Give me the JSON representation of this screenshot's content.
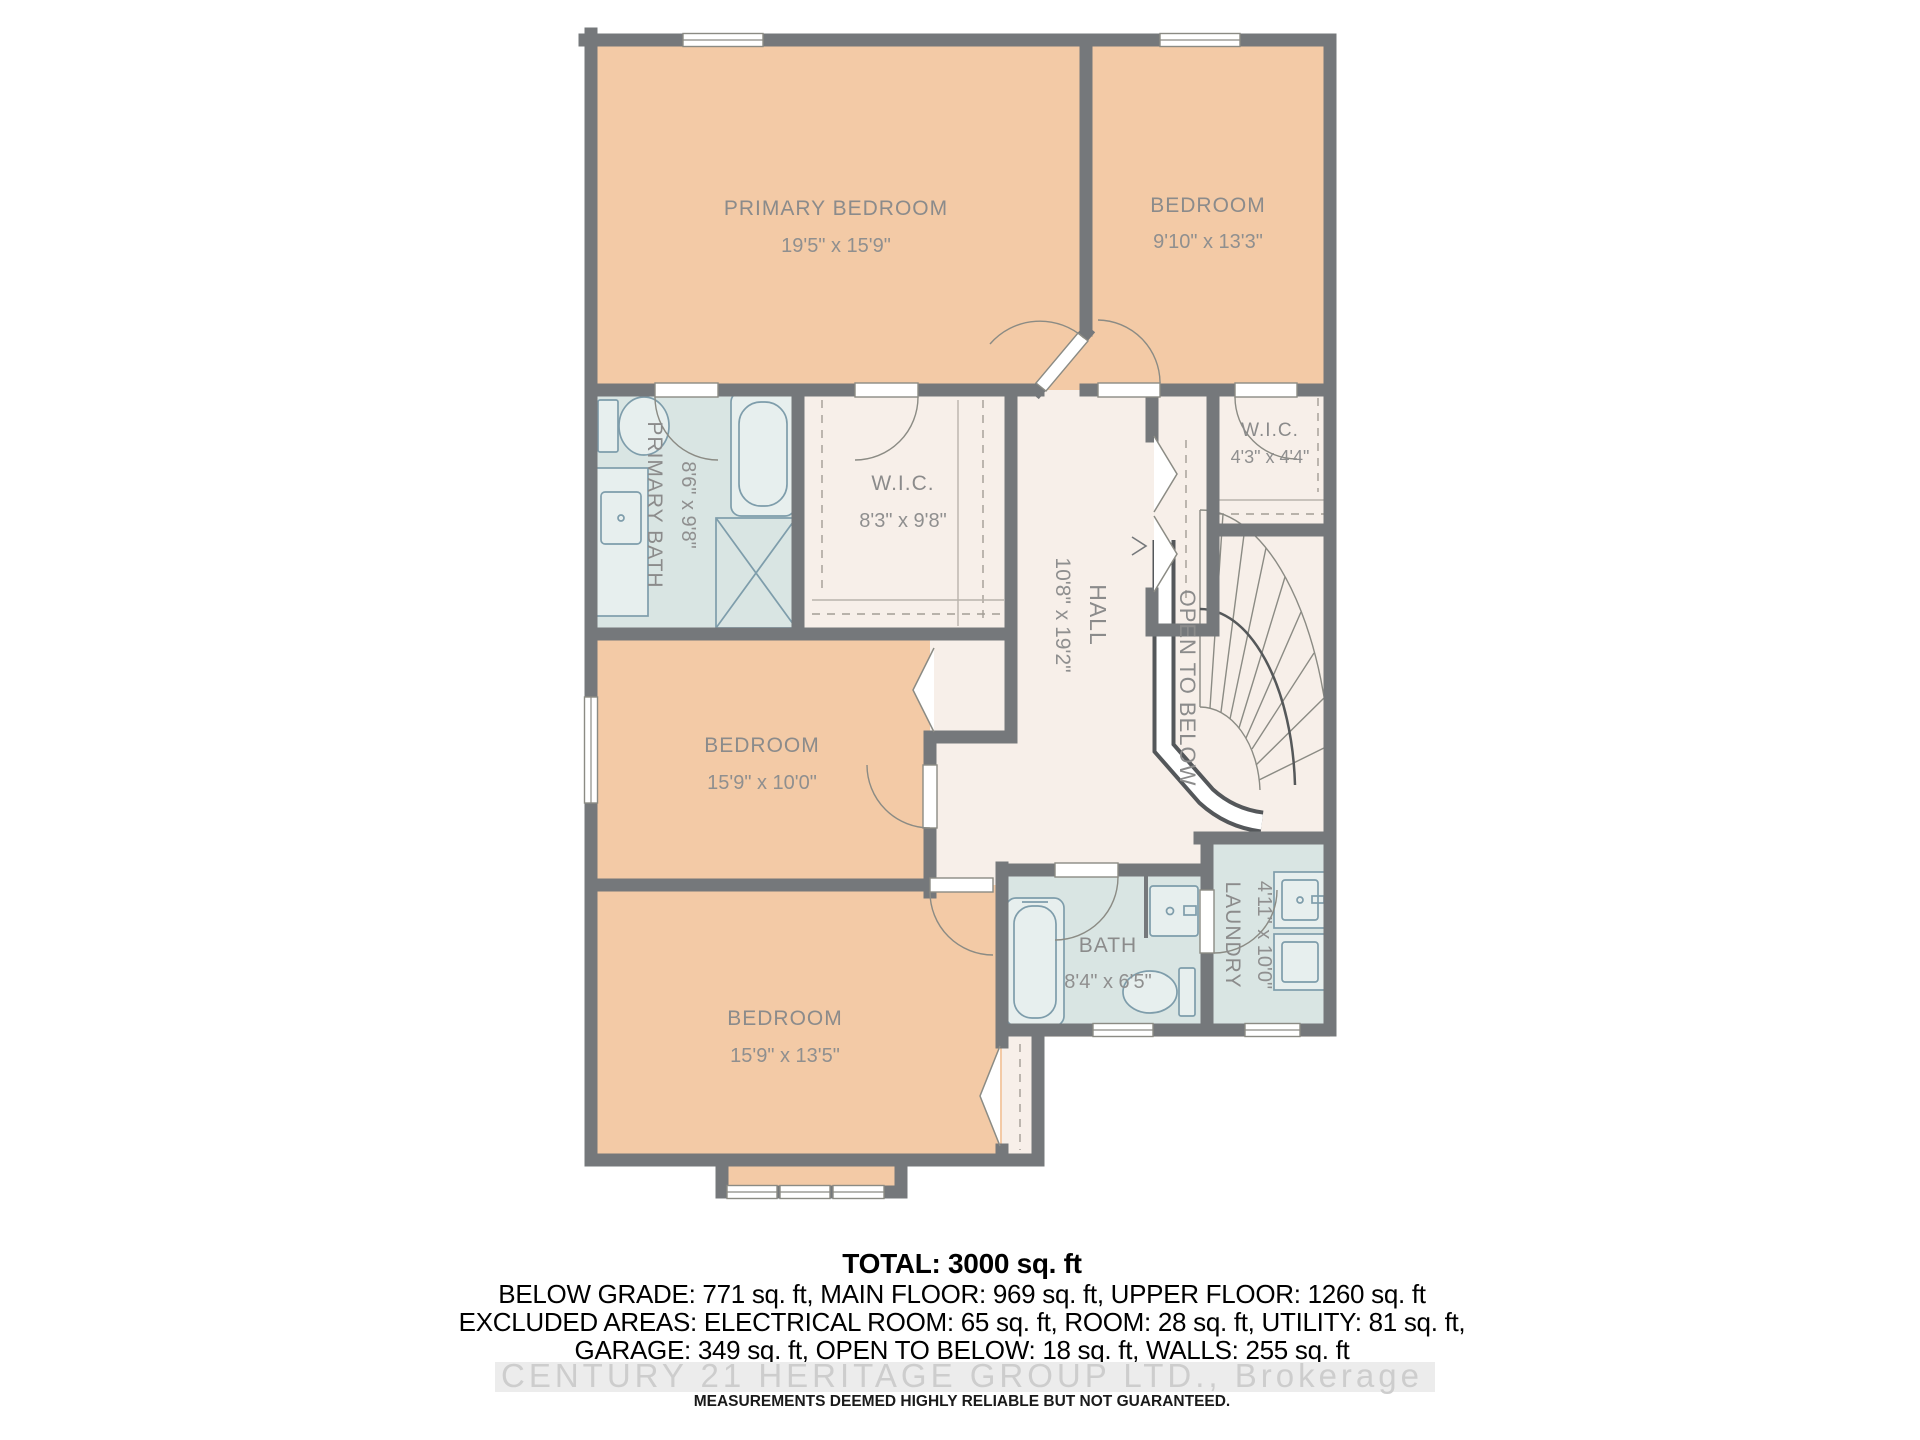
{
  "rooms": [
    {
      "name": "PRIMARY BEDROOM",
      "dims": "19'5\" x 15'9\""
    },
    {
      "name": "BEDROOM",
      "dims": "9'10\" x 13'3\""
    },
    {
      "name": "PRIMARY BATH",
      "dims": "8'6\" x 9'8\""
    },
    {
      "name": "W.I.C.",
      "dims": "8'3\" x 9'8\""
    },
    {
      "name": "W.I.C.",
      "dims": "4'3\" x 4'4\""
    },
    {
      "name": "HALL",
      "dims": "10'8\" x 19'2\""
    },
    {
      "name": "OPEN TO BELOW",
      "dims": ""
    },
    {
      "name": "BEDROOM",
      "dims": "15'9\" x 10'0\""
    },
    {
      "name": "BEDROOM",
      "dims": "15'9\" x 13'5\""
    },
    {
      "name": "BATH",
      "dims": "8'4\" x 6'5\""
    },
    {
      "name": "LAUNDRY",
      "dims": "4'11\" x 10'0\""
    }
  ],
  "summary": {
    "total": "TOTAL: 3000 sq. ft",
    "line1": "BELOW GRADE: 771 sq. ft, MAIN FLOOR: 969 sq. ft, UPPER FLOOR: 1260 sq. ft",
    "line2": "EXCLUDED AREAS: ELECTRICAL ROOM: 65 sq. ft, ROOM: 28 sq. ft, UTILITY: 81 sq. ft,",
    "line3": "GARAGE: 349 sq. ft, OPEN TO BELOW: 18 sq. ft, WALLS: 255 sq. ft"
  },
  "watermark": "CENTURY 21 HERITAGE GROUP LTD., Brokerage",
  "disclaimer": "MEASUREMENTS DEEMED HIGHLY RELIABLE BUT NOT GUARANTEED.",
  "colors": {
    "wall": "#75787b",
    "bedroom_fill": "#f3caa6",
    "bath_fill": "#d9e5e3",
    "hall_fill": "#f7efe9",
    "label": "#8b8b8b",
    "watermark": "#cdcdcd"
  }
}
